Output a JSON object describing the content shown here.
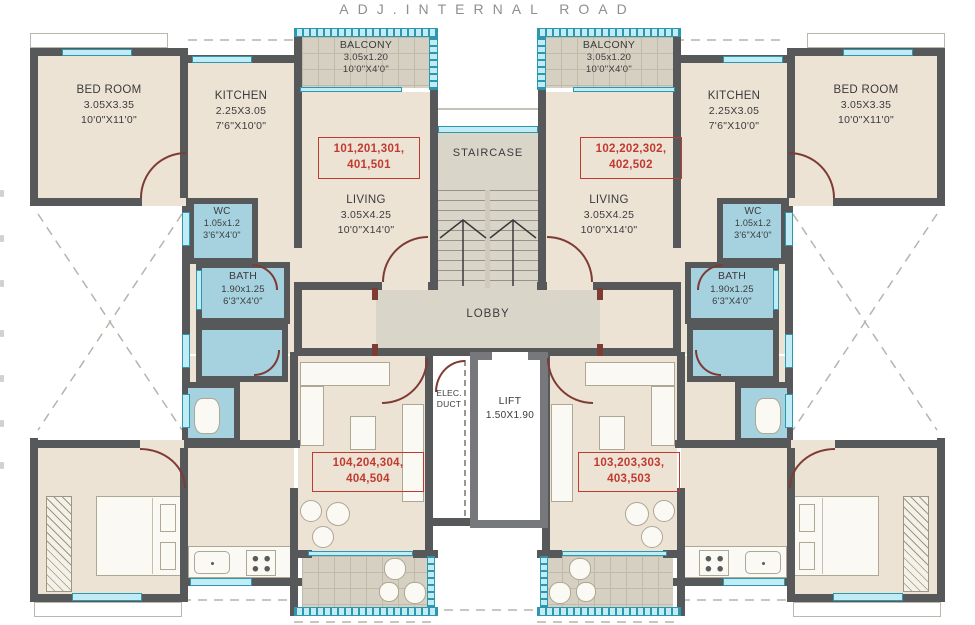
{
  "road_label": "ADJ.INTERNAL ROAD",
  "colors": {
    "wall": "#57585a",
    "wall_light": "#77787b",
    "room": "#ece3d5",
    "wet": "#a6d2e0",
    "common": "#d9d5c9",
    "tile": "#d6d0c2",
    "tile_line": "#c0baa9",
    "window": "#c2ecf5",
    "window_border": "#2d97ad",
    "red": "#c13a2f",
    "arc": "#7e3b33",
    "text": "#3b3b3c",
    "road": "#8f8f8f",
    "fur_fill": "#fbf9f3",
    "fur_line": "#ada794"
  },
  "units": {
    "u101": {
      "line1": "101,201,301,",
      "line2": "401,501"
    },
    "u102": {
      "line1": "102,202,302,",
      "line2": "402,502"
    },
    "u103": {
      "line1": "103,203,303,",
      "line2": "403,503"
    },
    "u104": {
      "line1": "104,204,304,",
      "line2": "404,504"
    }
  },
  "rooms": {
    "bedroom_tl": {
      "name": "BED ROOM",
      "dim_m": "3.05X3.35",
      "dim_ft": "10'0\"X11'0\""
    },
    "kitchen_tl": {
      "name": "KITCHEN",
      "dim_m": "2.25X3.05",
      "dim_ft": "7'6\"X10'0\""
    },
    "balcony_tl": {
      "name": "BALCONY",
      "dim_m": "3.05x1.20",
      "dim_ft": "10'0\"X4'0\""
    },
    "living_tl": {
      "name": "LIVING",
      "dim_m": "3.05X4.25",
      "dim_ft": "10'0\"X14'0\""
    },
    "wc_left": {
      "name": "WC",
      "dim_m": "1.05x1.2",
      "dim_ft": "3'6\"X4'0\""
    },
    "bath_left": {
      "name": "BATH",
      "dim_m": "1.90x1.25",
      "dim_ft": "6'3\"X4'0\""
    },
    "bedroom_tr": {
      "name": "BED ROOM",
      "dim_m": "3.05X3.35",
      "dim_ft": "10'0\"X11'0\""
    },
    "kitchen_tr": {
      "name": "KITCHEN",
      "dim_m": "2.25X3.05",
      "dim_ft": "7'6\"X10'0\""
    },
    "balcony_tr": {
      "name": "BALCONY",
      "dim_m": "3.05x1.20",
      "dim_ft": "10'0\"X4'0\""
    },
    "living_tr": {
      "name": "LIVING",
      "dim_m": "3.05X4.25",
      "dim_ft": "10'0\"X14'0\""
    },
    "wc_right": {
      "name": "WC",
      "dim_m": "1.05x1.2",
      "dim_ft": "3'6\"X4'0\""
    },
    "bath_right": {
      "name": "BATH",
      "dim_m": "1.90x1.25",
      "dim_ft": "6'3\"X4'0\""
    },
    "staircase": {
      "name": "STAIRCASE"
    },
    "lobby": {
      "name": "LOBBY"
    },
    "elec_duct": {
      "line1": "ELEC.",
      "line2": "DUCT"
    },
    "lift": {
      "name": "LIFT",
      "dim_m": "1.50X1.90"
    }
  }
}
